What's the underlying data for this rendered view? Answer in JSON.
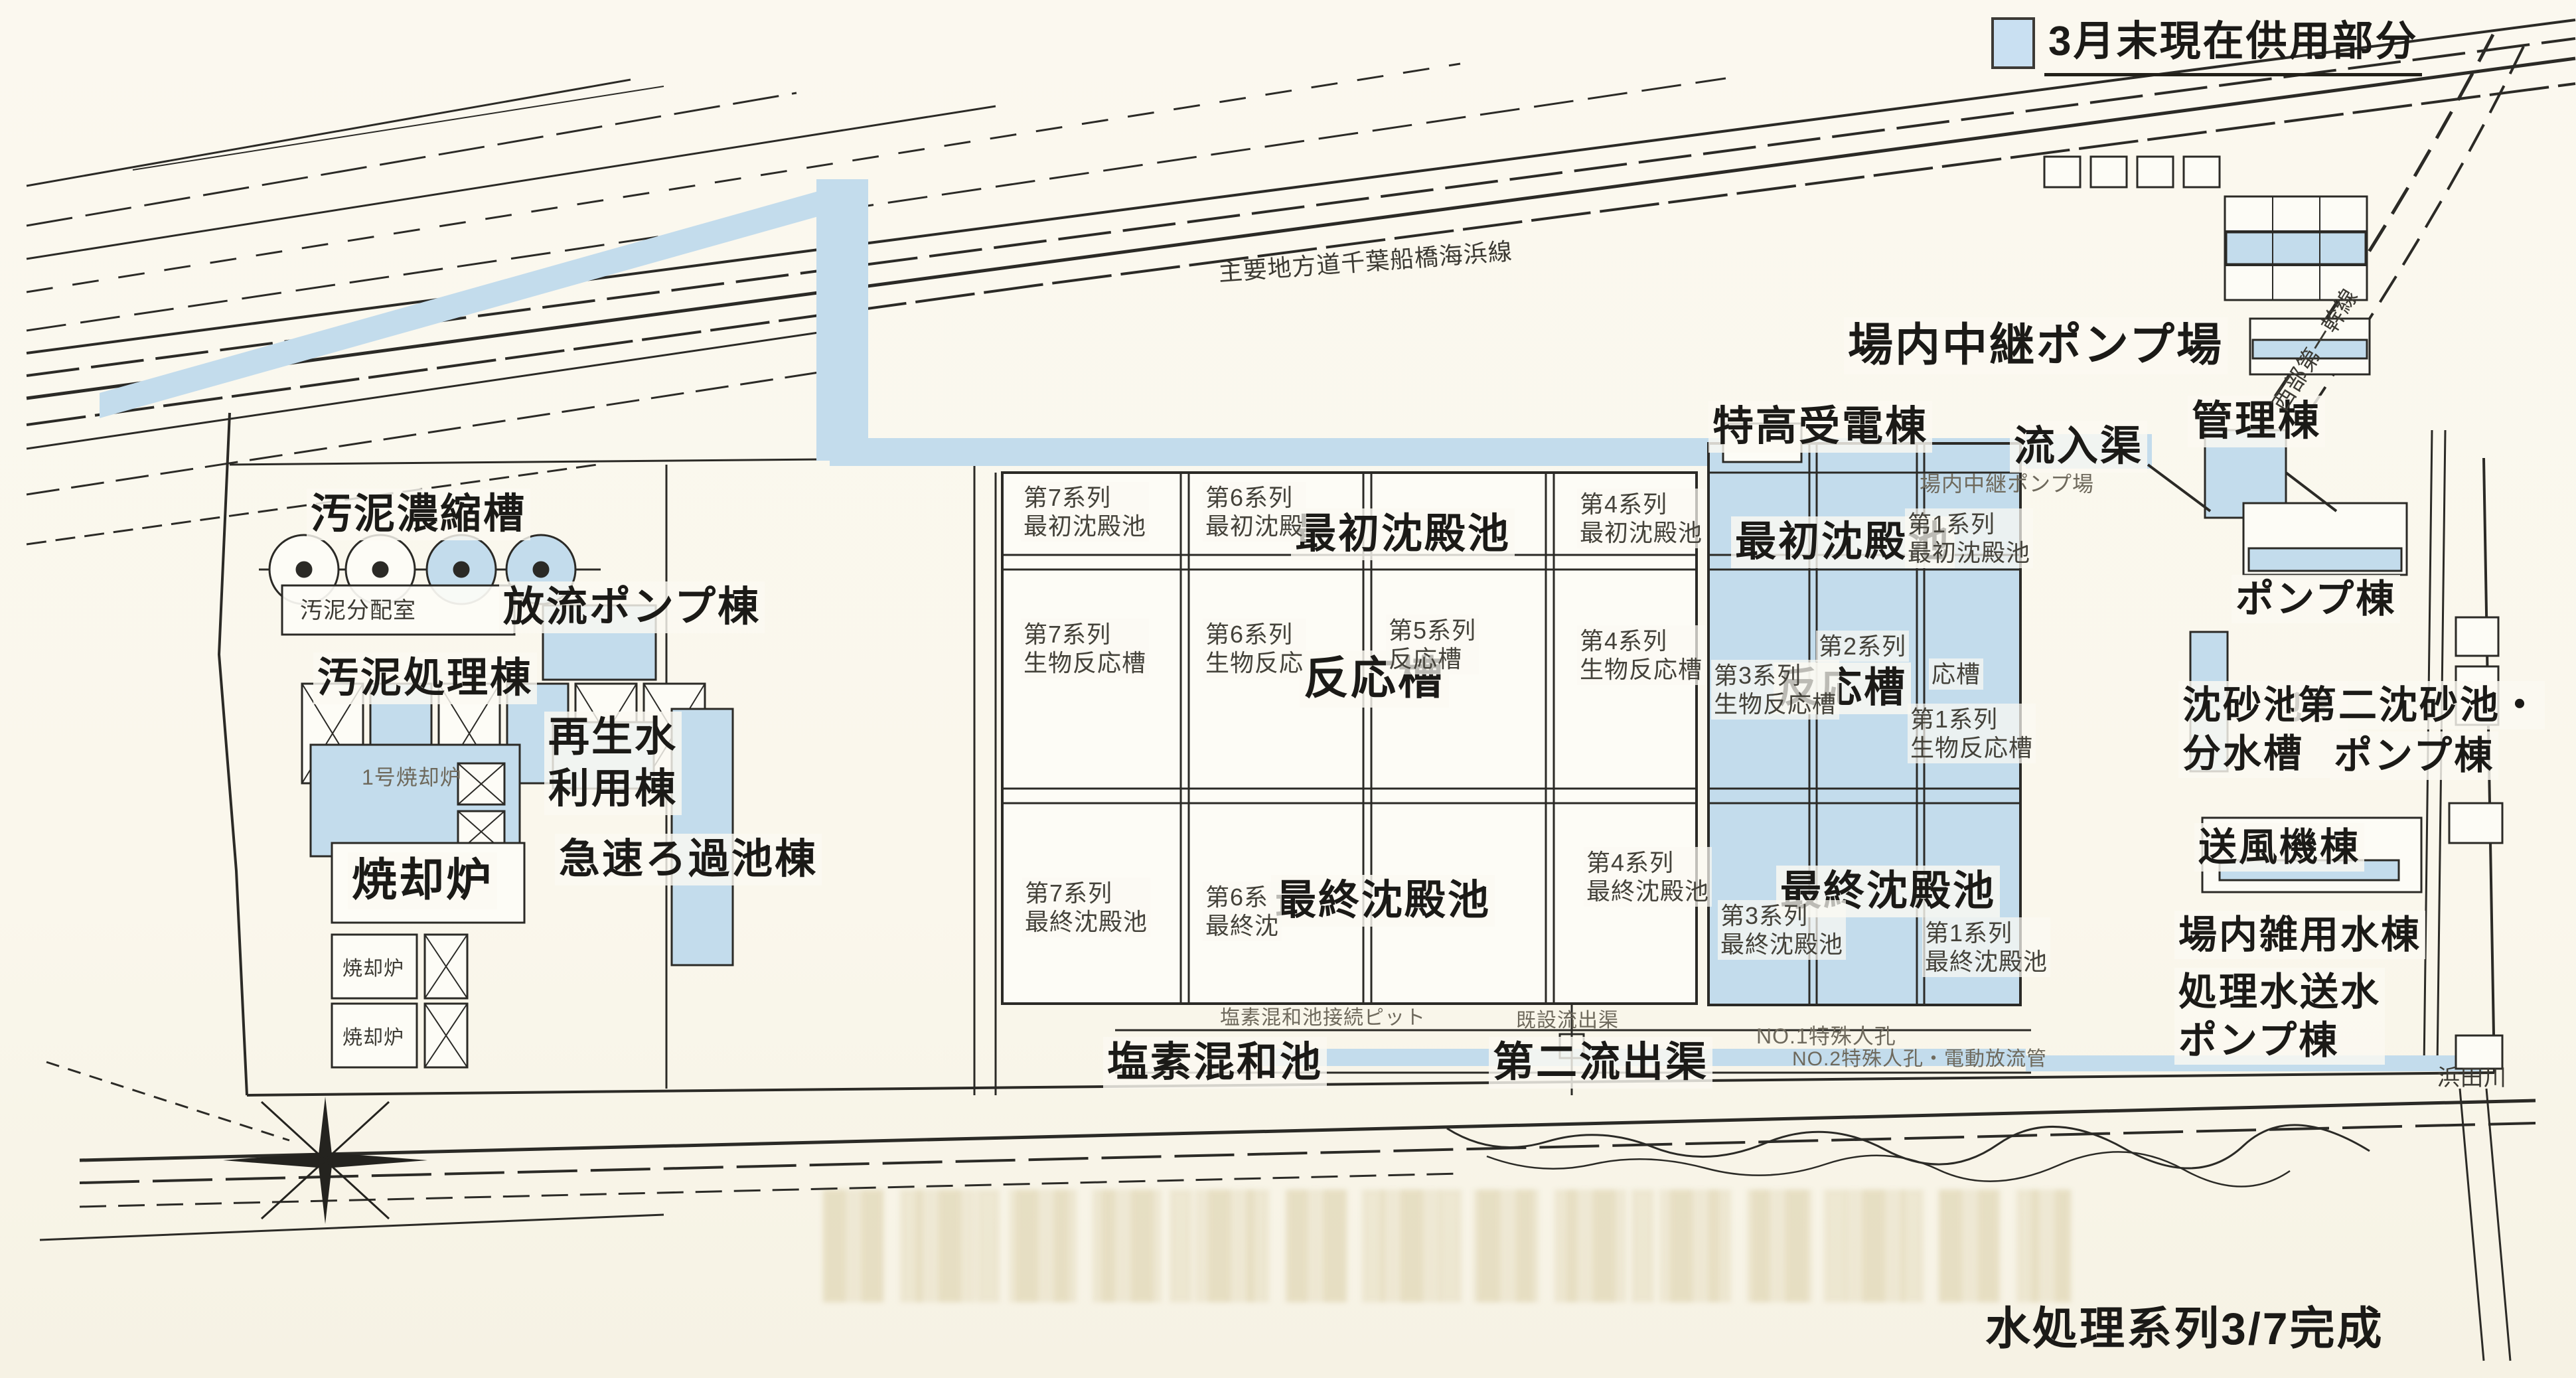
{
  "legend": {
    "label": "3月末現在供用部分",
    "swatch_color": "#c9e0f2"
  },
  "caption": "水処理系列3/7完成",
  "colors": {
    "supplied_blue": "#c3dcec",
    "paper": "#faf7ec",
    "ink": "#2b2a26"
  },
  "roads": {
    "highway": "主要地方道千葉船橋海浜線",
    "trunk_line": "西部第一幹線",
    "river": "浜田川"
  },
  "facilities": {
    "sludge_thickener": "汚泥濃縮槽",
    "sludge_distribution": "汚泥分配室",
    "discharge_pump": "放流ポンプ棟",
    "sludge_treatment": "汚泥処理棟",
    "reclaimed_water": "再生水\n利用棟",
    "rapid_filter": "急速ろ過池棟",
    "incinerator": "焼却炉",
    "incinerator_no1": "1号焼却炉",
    "incinerator_small_1": "焼却炉",
    "incinerator_small_2": "焼却炉",
    "onsite_relay_pump": "場内中継ポンプ場",
    "onsite_relay_pump_ghost": "場内中継ポンプ場",
    "extra_high_voltage": "特高受電棟",
    "inflow_channel": "流入渠",
    "admin": "管理棟",
    "pump_building": "ポンプ棟",
    "grit_division": "沈砂池・\n分水槽",
    "second_grit": "第二沈砂池・",
    "second_grit_pump": "ポンプ棟",
    "blower": "送風機棟",
    "misc_water": "場内雑用水棟",
    "treated_water_pump": "処理水送水\nポンプ棟",
    "chlorine_basin": "塩素混和池",
    "second_outlet": "第二流出渠",
    "chlorine_pit": "塩素混和池接続ピット",
    "existing_outlet": "既設流出渠",
    "manhole_no1": "NO.1特殊人孔",
    "manhole_no2": "NO.2特殊人孔・電動放流管"
  },
  "pools": {
    "primary_big": "最初沈殿池",
    "reactor_big": "反応槽",
    "final_big": "最終沈殿池",
    "cells": {
      "s7_primary": "第7系列\n最初沈殿池",
      "s6_primary": "第6系列\n最初沈殿",
      "s4_primary": "第4系列\n最初沈殿池",
      "s1_primary": "第1系列\n最初沈殿池",
      "s7_reactor": "第7系列\n生物反応槽",
      "s6_reactor": "第6系列\n生物反応",
      "s5_reactor": "第5系列\n反応槽",
      "s4_reactor": "第4系列\n生物反応槽",
      "s3_reactor": "第3系列\n生物反応槽",
      "s2_reactor": "第2系列",
      "s2_reactor_frag": "応槽",
      "s1_reactor": "第1系列\n生物反応槽",
      "s7_final": "第7系列\n最終沈殿池",
      "s6_final": "第6系\n最終沈",
      "s4_final": "第4系列\n最終沈殿池",
      "s3_final": "第3系列\n最終沈殿池",
      "s1_final": "第1系列\n最終沈殿池"
    }
  }
}
